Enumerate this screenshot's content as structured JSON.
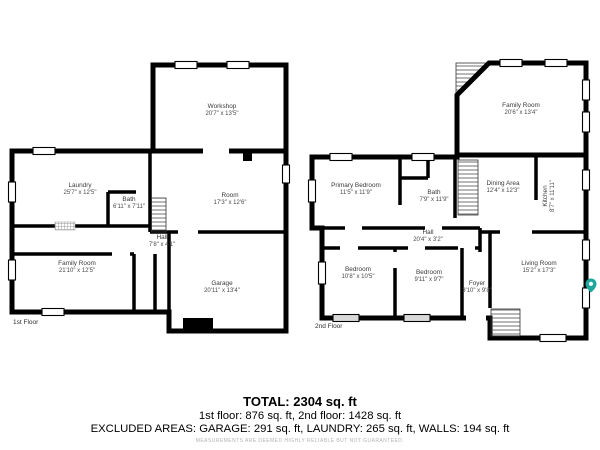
{
  "floor1": {
    "label": "1st Floor",
    "rooms": {
      "workshop": {
        "name": "Workshop",
        "dims": "20'7\" x 13'5\""
      },
      "laundry": {
        "name": "Laundry",
        "dims": "25'7\" x 12'5\""
      },
      "bath": {
        "name": "Bath",
        "dims": "6'11\" x 7'11\""
      },
      "room": {
        "name": "Room",
        "dims": "17'3\" x 12'6\""
      },
      "hall": {
        "name": "Hall",
        "dims": "7'8\" x 4'1\""
      },
      "family_room": {
        "name": "Family Room",
        "dims": "21'10\" x 12'5\""
      },
      "garage": {
        "name": "Garage",
        "dims": "20'11\" x 13'4\""
      }
    }
  },
  "floor2": {
    "label": "2nd Floor",
    "rooms": {
      "family_room": {
        "name": "Family Room",
        "dims": "20'6\" x 13'4\""
      },
      "primary_bedroom": {
        "name": "Primary Bedroom",
        "dims": "11'5\" x 11'9\""
      },
      "bath": {
        "name": "Bath",
        "dims": "7'9\" x 11'9\""
      },
      "dining_area": {
        "name": "Dining Area",
        "dims": "12'4\" x 12'3\""
      },
      "kitchen": {
        "name": "Kitchen",
        "dims": "8'7\" x 11'11\""
      },
      "hall": {
        "name": "Hall",
        "dims": "20'4\" x 3'2\""
      },
      "bedroom1": {
        "name": "Bedroom",
        "dims": "10'8\" x 10'5\""
      },
      "bedroom2": {
        "name": "Bedroom",
        "dims": "9'11\" x 9'7\""
      },
      "foyer": {
        "name": "Foyer",
        "dims": "3'10\" x 9'8\""
      },
      "living_room": {
        "name": "Living Room",
        "dims": "15'2\" x 17'3\""
      }
    }
  },
  "summary": {
    "total": "TOTAL: 2304 sq. ft",
    "floors": "1st floor: 876 sq. ft, 2nd floor: 1428 sq. ft",
    "excluded": "EXCLUDED AREAS: GARAGE: 291 sq. ft, LAUNDRY: 265 sq. ft, WALLS: 194 sq. ft",
    "disclaimer": "MEASUREMENTS ARE DEEMED HIGHLY RELIABLE BUT NOT GUARANTEED."
  },
  "watermark": {
    "color": "#1ba79c"
  }
}
